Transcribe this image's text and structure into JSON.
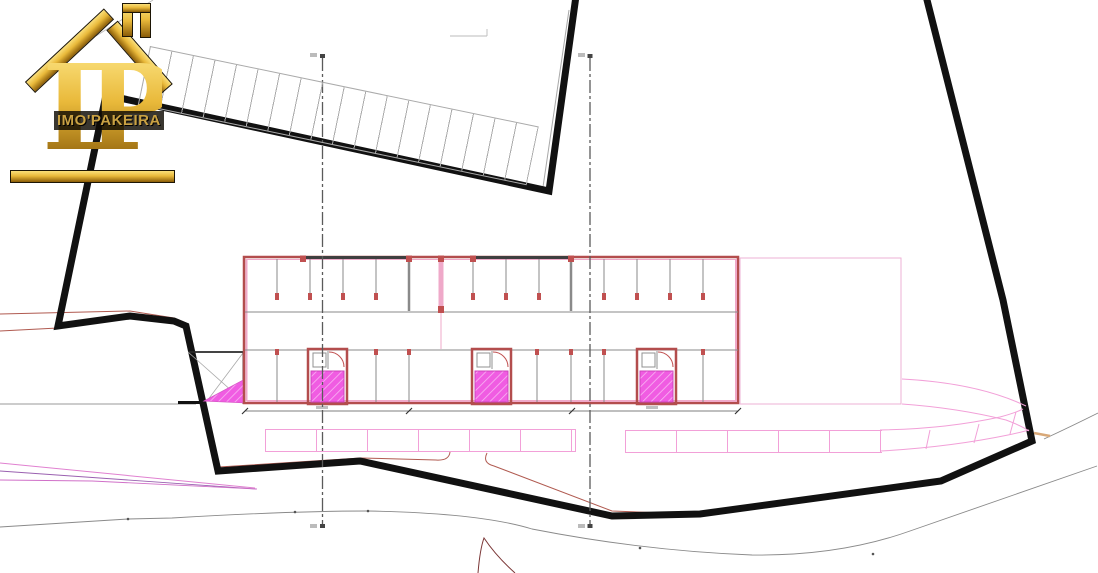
{
  "document": {
    "type": "architectural-site-plan",
    "description": "Site implantation plan: plot boundary in heavy black line, single-storey garage/parking building with three stair cores (magenta hatch), perpendicular parking stalls along the top boundary and along the lower access road, section centerlines and dimension line."
  },
  "logo": {
    "monogram": "IP",
    "brand": "IMO'PAKEIRA",
    "icon": "gold-house-roof-with-chimney"
  },
  "colors": {
    "boundary": "#111111",
    "wall_red": "#b34d4d",
    "wall_pink": "#efa9c9",
    "hatch_magenta": "#f05ce2",
    "hatch_border": "#cc44bb",
    "parking_pink": "#f2a0d8",
    "road_gray": "#8a8a8a",
    "trace_red": "#b05a50",
    "centerline_gray": "#5a5a5a",
    "stall_gray": "#aaaaaa",
    "gold": "#e9b93a",
    "gold_light": "#fadf7a",
    "gold_dark": "#8a5c08",
    "brand_text": "#caa243",
    "dark_red": "#7a3535",
    "tan": "#d8a878"
  },
  "plan_features": {
    "stair_cores": 3,
    "upper_stall_band": "diagonal row of parking stalls inside top boundary",
    "lower_stall_rows": 2,
    "section_lines": 2
  }
}
